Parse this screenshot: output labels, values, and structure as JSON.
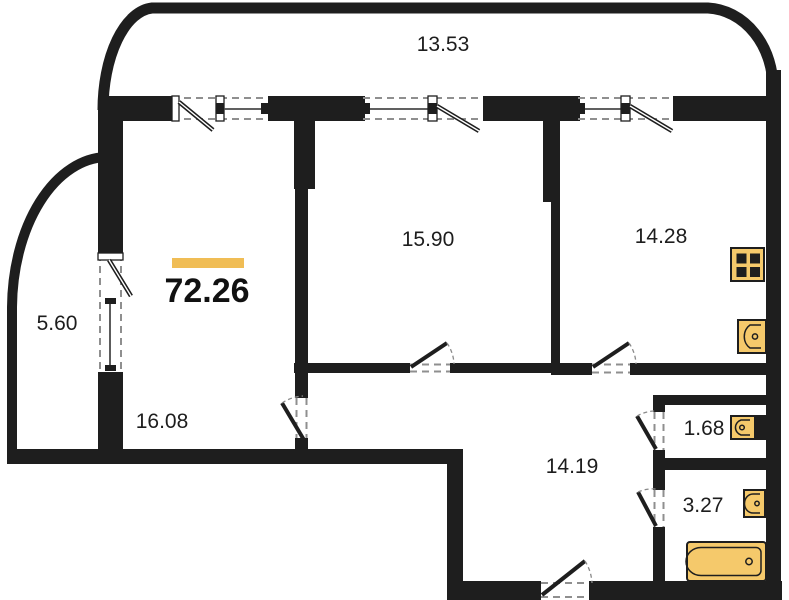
{
  "plan": {
    "total_area": "72.26",
    "rooms": {
      "balcony_top": "13.53",
      "room_main": "15.90",
      "kitchen": "14.28",
      "balcony_left": "5.60",
      "living": "16.08",
      "hallway": "14.19",
      "wc": "1.68",
      "bathroom": "3.27"
    },
    "colors": {
      "wall": "#1e1e1e",
      "accent_bar": "#F0BD55",
      "fixture_fill": "#F5C96B",
      "label_text": "#1d1d1d",
      "background": "#ffffff"
    }
  }
}
